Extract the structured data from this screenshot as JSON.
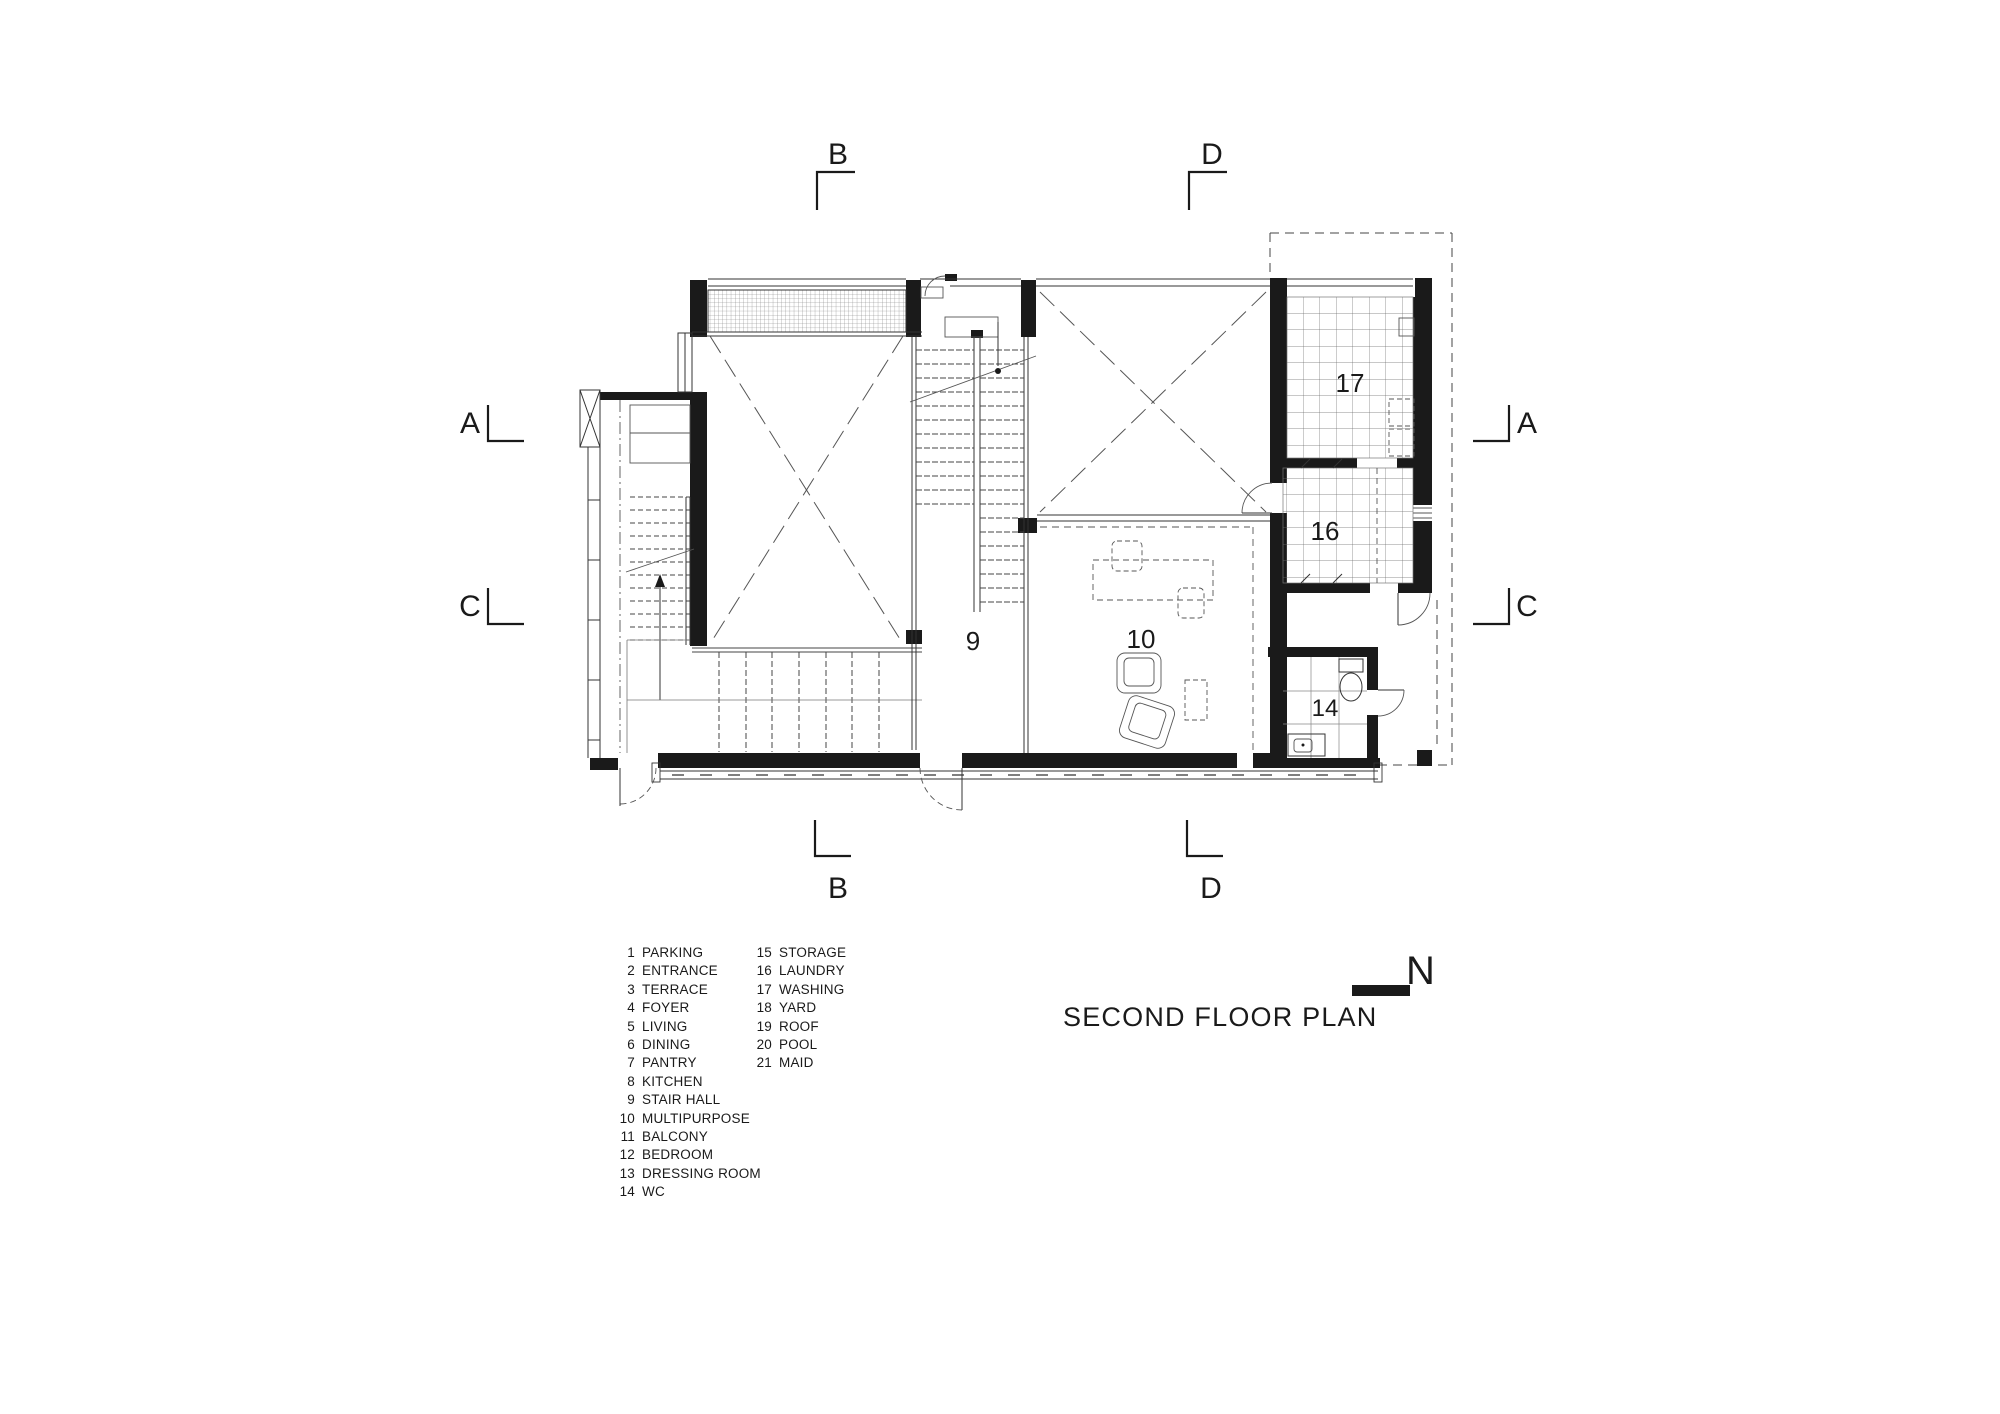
{
  "title": "SECOND FLOOR PLAN",
  "north": "N",
  "colors": {
    "ink": "#1a1a1a",
    "thin_line": "#555555",
    "tile_line": "#777777"
  },
  "plan": {
    "sections": {
      "a": "A",
      "b": "B",
      "c": "C",
      "d": "D"
    },
    "rooms": {
      "stair_hall": "9",
      "multipurpose": "10",
      "wc": "14",
      "laundry": "16",
      "washing": "17"
    }
  },
  "legend": {
    "col1": [
      {
        "num": "1",
        "label": "PARKING"
      },
      {
        "num": "2",
        "label": "ENTRANCE"
      },
      {
        "num": "3",
        "label": "TERRACE"
      },
      {
        "num": "4",
        "label": "FOYER"
      },
      {
        "num": "5",
        "label": "LIVING"
      },
      {
        "num": "6",
        "label": "DINING"
      },
      {
        "num": "7",
        "label": "PANTRY"
      },
      {
        "num": "8",
        "label": "KITCHEN"
      },
      {
        "num": "9",
        "label": "STAIR HALL"
      },
      {
        "num": "10",
        "label": "MULTIPURPOSE"
      },
      {
        "num": "11",
        "label": "BALCONY"
      },
      {
        "num": "12",
        "label": "BEDROOM"
      },
      {
        "num": "13",
        "label": "DRESSING ROOM"
      },
      {
        "num": "14",
        "label": "WC"
      }
    ],
    "col2": [
      {
        "num": "15",
        "label": "STORAGE"
      },
      {
        "num": "16",
        "label": "LAUNDRY"
      },
      {
        "num": "17",
        "label": "WASHING"
      },
      {
        "num": "18",
        "label": "YARD"
      },
      {
        "num": "19",
        "label": "ROOF"
      },
      {
        "num": "20",
        "label": "POOL"
      },
      {
        "num": "21",
        "label": "MAID"
      }
    ]
  }
}
